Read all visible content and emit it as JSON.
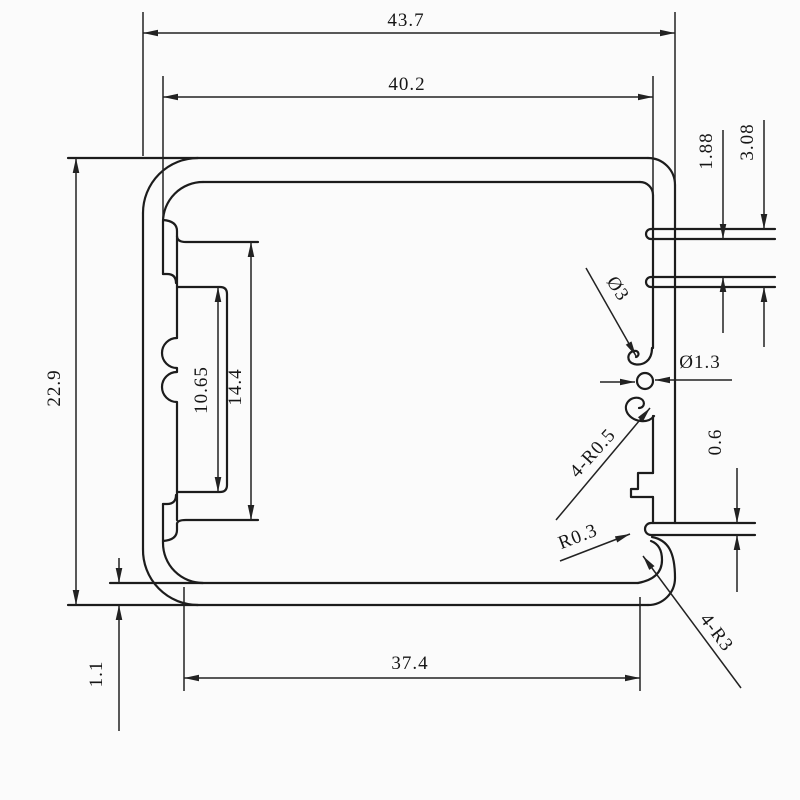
{
  "drawing": {
    "type": "aluminum-extrusion-profile-cross-section",
    "background_color": "#fbfbfb",
    "line_color": "#1c1c1c",
    "labels": {
      "overall_width": "43.7",
      "inner_width": "40.2",
      "overall_height": "22.9",
      "bottom_wall_thickness": "1.1",
      "bottom_width": "37.4",
      "channel_inner_height": "10.65",
      "channel_outer_height": "14.4",
      "fin_gap": "1.88",
      "fin_span": "3.08",
      "fin_thickness": "0.6",
      "boss_diameter": "Ø3",
      "hole_diameter": "Ø1.3",
      "jaw_radius": "4-R0.5",
      "slot_radius": "R0.3",
      "corner_radius": "4-R3"
    }
  }
}
